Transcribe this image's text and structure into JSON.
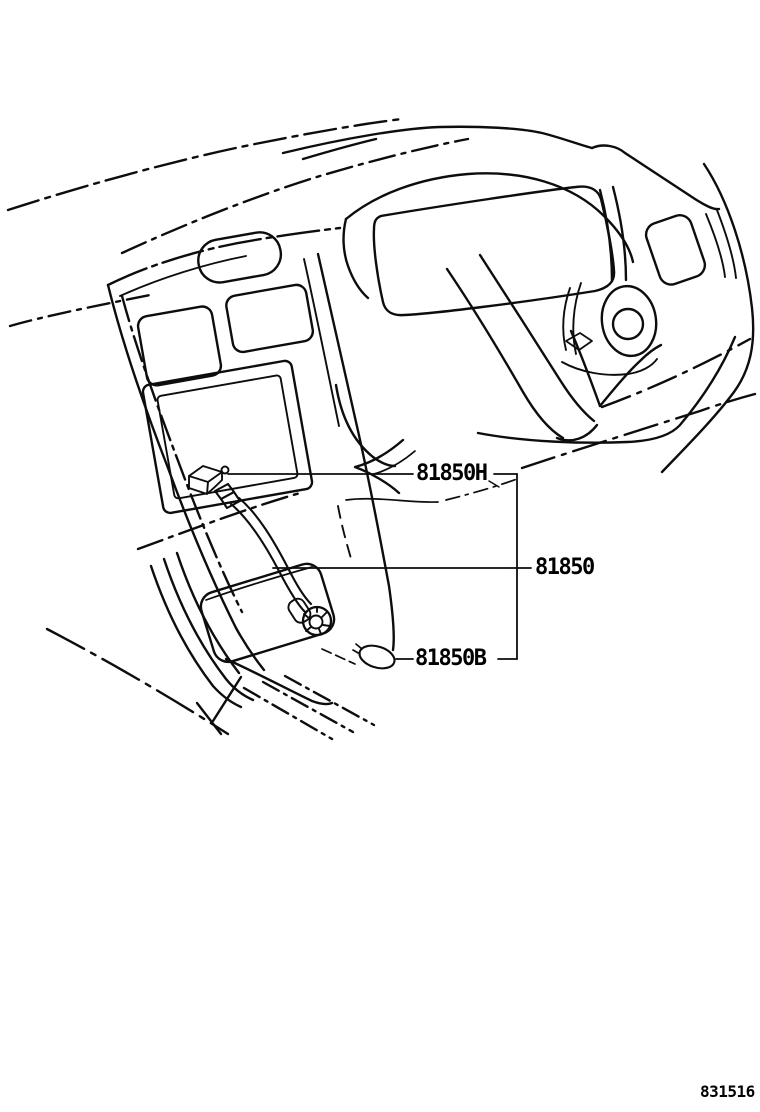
{
  "page": {
    "background_color": "#ffffff",
    "line_color": "#0d0d0d"
  },
  "diagram": {
    "type": "parts-illustration",
    "subject": "instrument-panel-dashboard-line-art",
    "callouts": [
      {
        "part_no": "81850H"
      },
      {
        "part_no": "81850"
      },
      {
        "part_no": "81850B"
      }
    ],
    "figure_code": "831516"
  }
}
